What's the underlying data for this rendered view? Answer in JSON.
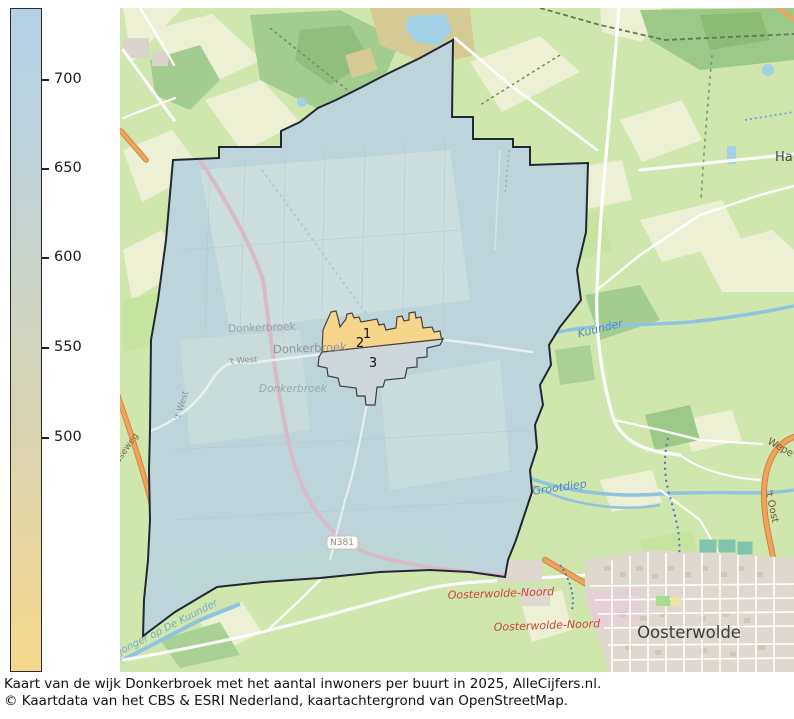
{
  "caption": {
    "line1": "Kaart van de wijk Donkerbroek met het aantal inwoners per buurt in 2025, AlleCijfers.nl.",
    "line2": "© Kaartdata van het CBS & ESRI Nederland, kaartachtergrond van OpenStreetMap."
  },
  "colorbar": {
    "ticks": [
      {
        "label": "700",
        "offset": 71
      },
      {
        "label": "650",
        "offset": 160
      },
      {
        "label": "600",
        "offset": 249
      },
      {
        "label": "550",
        "offset": 339
      },
      {
        "label": "500",
        "offset": 429
      }
    ],
    "gradient_top_color": "#b4d1e5",
    "gradient_bottom_color": "#f6d88c"
  },
  "map": {
    "labels": [
      {
        "name": "kuunder-river-label",
        "text": "Kuunder",
        "x": 601,
        "y": 332,
        "size": 11,
        "color": "#4f8cba",
        "rot": -14,
        "italic": true,
        "bold": false
      },
      {
        "name": "grootdiep-river-label",
        "text": "Grootdiep",
        "x": 560,
        "y": 491,
        "size": 11,
        "color": "#4f8cba",
        "rot": -8,
        "italic": true,
        "bold": false
      },
      {
        "name": "tsjonger-canal-label",
        "text": "Tsjonger op De Kuunder",
        "x": 165,
        "y": 632,
        "size": 10,
        "color": "#79a9cc",
        "rot": -27,
        "italic": true,
        "bold": false
      },
      {
        "name": "donkerbroek-town-label-1",
        "text": "Donkerbroek",
        "x": 262,
        "y": 331,
        "size": 10.5,
        "color": "#98a1a4",
        "rot": -2,
        "italic": false,
        "bold": false
      },
      {
        "name": "donkerbroek-town-label-2",
        "text": "Donkerbroek",
        "x": 310,
        "y": 352,
        "size": 11.5,
        "color": "#8d9497",
        "rot": -2,
        "italic": false,
        "bold": false
      },
      {
        "name": "donkerbroek-town-label-3",
        "text": "Donkerbroek",
        "x": 293,
        "y": 392,
        "size": 10.5,
        "color": "#9aa7ab",
        "rot": 0,
        "italic": true,
        "bold": false
      },
      {
        "name": "t-west-road-label-1",
        "text": "'t West",
        "x": 243,
        "y": 363,
        "size": 8.5,
        "color": "#8d9296",
        "rot": -4,
        "italic": false,
        "bold": false
      },
      {
        "name": "t-west-road-label-2",
        "text": "'t West",
        "x": 184,
        "y": 406,
        "size": 8.5,
        "color": "#8d9296",
        "rot": -73,
        "italic": false,
        "bold": false
      },
      {
        "name": "ndseweg-road-label",
        "text": "ndseweg",
        "x": 127,
        "y": 452,
        "size": 9,
        "color": "#8a6a3f",
        "rot": -55,
        "italic": false,
        "bold": false
      },
      {
        "name": "n381-road-badge-label",
        "text": "N381",
        "x": 342,
        "y": 545,
        "size": 9,
        "color": "#8f8f8f",
        "rot": 0,
        "italic": false,
        "bold": false
      },
      {
        "name": "weperweg-road-label",
        "text": "Wepe",
        "x": 779,
        "y": 450,
        "size": 10,
        "color": "#6f5536",
        "rot": 30,
        "italic": false,
        "bold": false
      },
      {
        "name": "t-oost-road-label",
        "text": "'t Oost",
        "x": 769,
        "y": 507,
        "size": 10,
        "color": "#6f5536",
        "rot": 78,
        "italic": false,
        "bold": false
      },
      {
        "name": "haule-town-label",
        "text": "Hau",
        "x": 788,
        "y": 161,
        "size": 13,
        "color": "#454545",
        "rot": 0,
        "italic": false,
        "bold": false
      },
      {
        "name": "oosterwolde-town-label",
        "text": "Oosterwolde",
        "x": 689,
        "y": 638,
        "size": 16.5,
        "color": "#3d3d3d",
        "rot": 0,
        "italic": false,
        "bold": false
      },
      {
        "name": "oosterwolde-noord-road-label-1",
        "text": "Oosterwolde-Noord",
        "x": 501,
        "y": 597,
        "size": 11,
        "color": "#cd4538",
        "rot": -2,
        "italic": true,
        "bold": false
      },
      {
        "name": "oosterwolde-noord-road-label-2",
        "text": "Oosterwolde-Noord",
        "x": 547,
        "y": 629,
        "size": 11,
        "color": "#cd4538",
        "rot": -2,
        "italic": true,
        "bold": false
      },
      {
        "name": "buurt-number-1",
        "text": "1",
        "x": 367,
        "y": 338,
        "size": 13,
        "color": "#111111",
        "rot": 0,
        "italic": false,
        "bold": false
      },
      {
        "name": "buurt-number-2",
        "text": "2",
        "x": 360,
        "y": 347,
        "size": 13,
        "color": "#111111",
        "rot": 0,
        "italic": false,
        "bold": false
      },
      {
        "name": "buurt-number-3",
        "text": "3",
        "x": 373,
        "y": 367,
        "size": 13,
        "color": "#111111",
        "rot": 0,
        "italic": false,
        "bold": false
      }
    ]
  },
  "colors": {
    "wijk_fill": "#bdd5da",
    "buurt_1_2_fill": "#f8d58d",
    "buurt_3_fill": "#ced7db",
    "boundary": "#232733",
    "water": "#90c3e0",
    "orange_road": "#f2a25c",
    "background_green": "#cfe6ad",
    "red_label": "#cd4538"
  }
}
